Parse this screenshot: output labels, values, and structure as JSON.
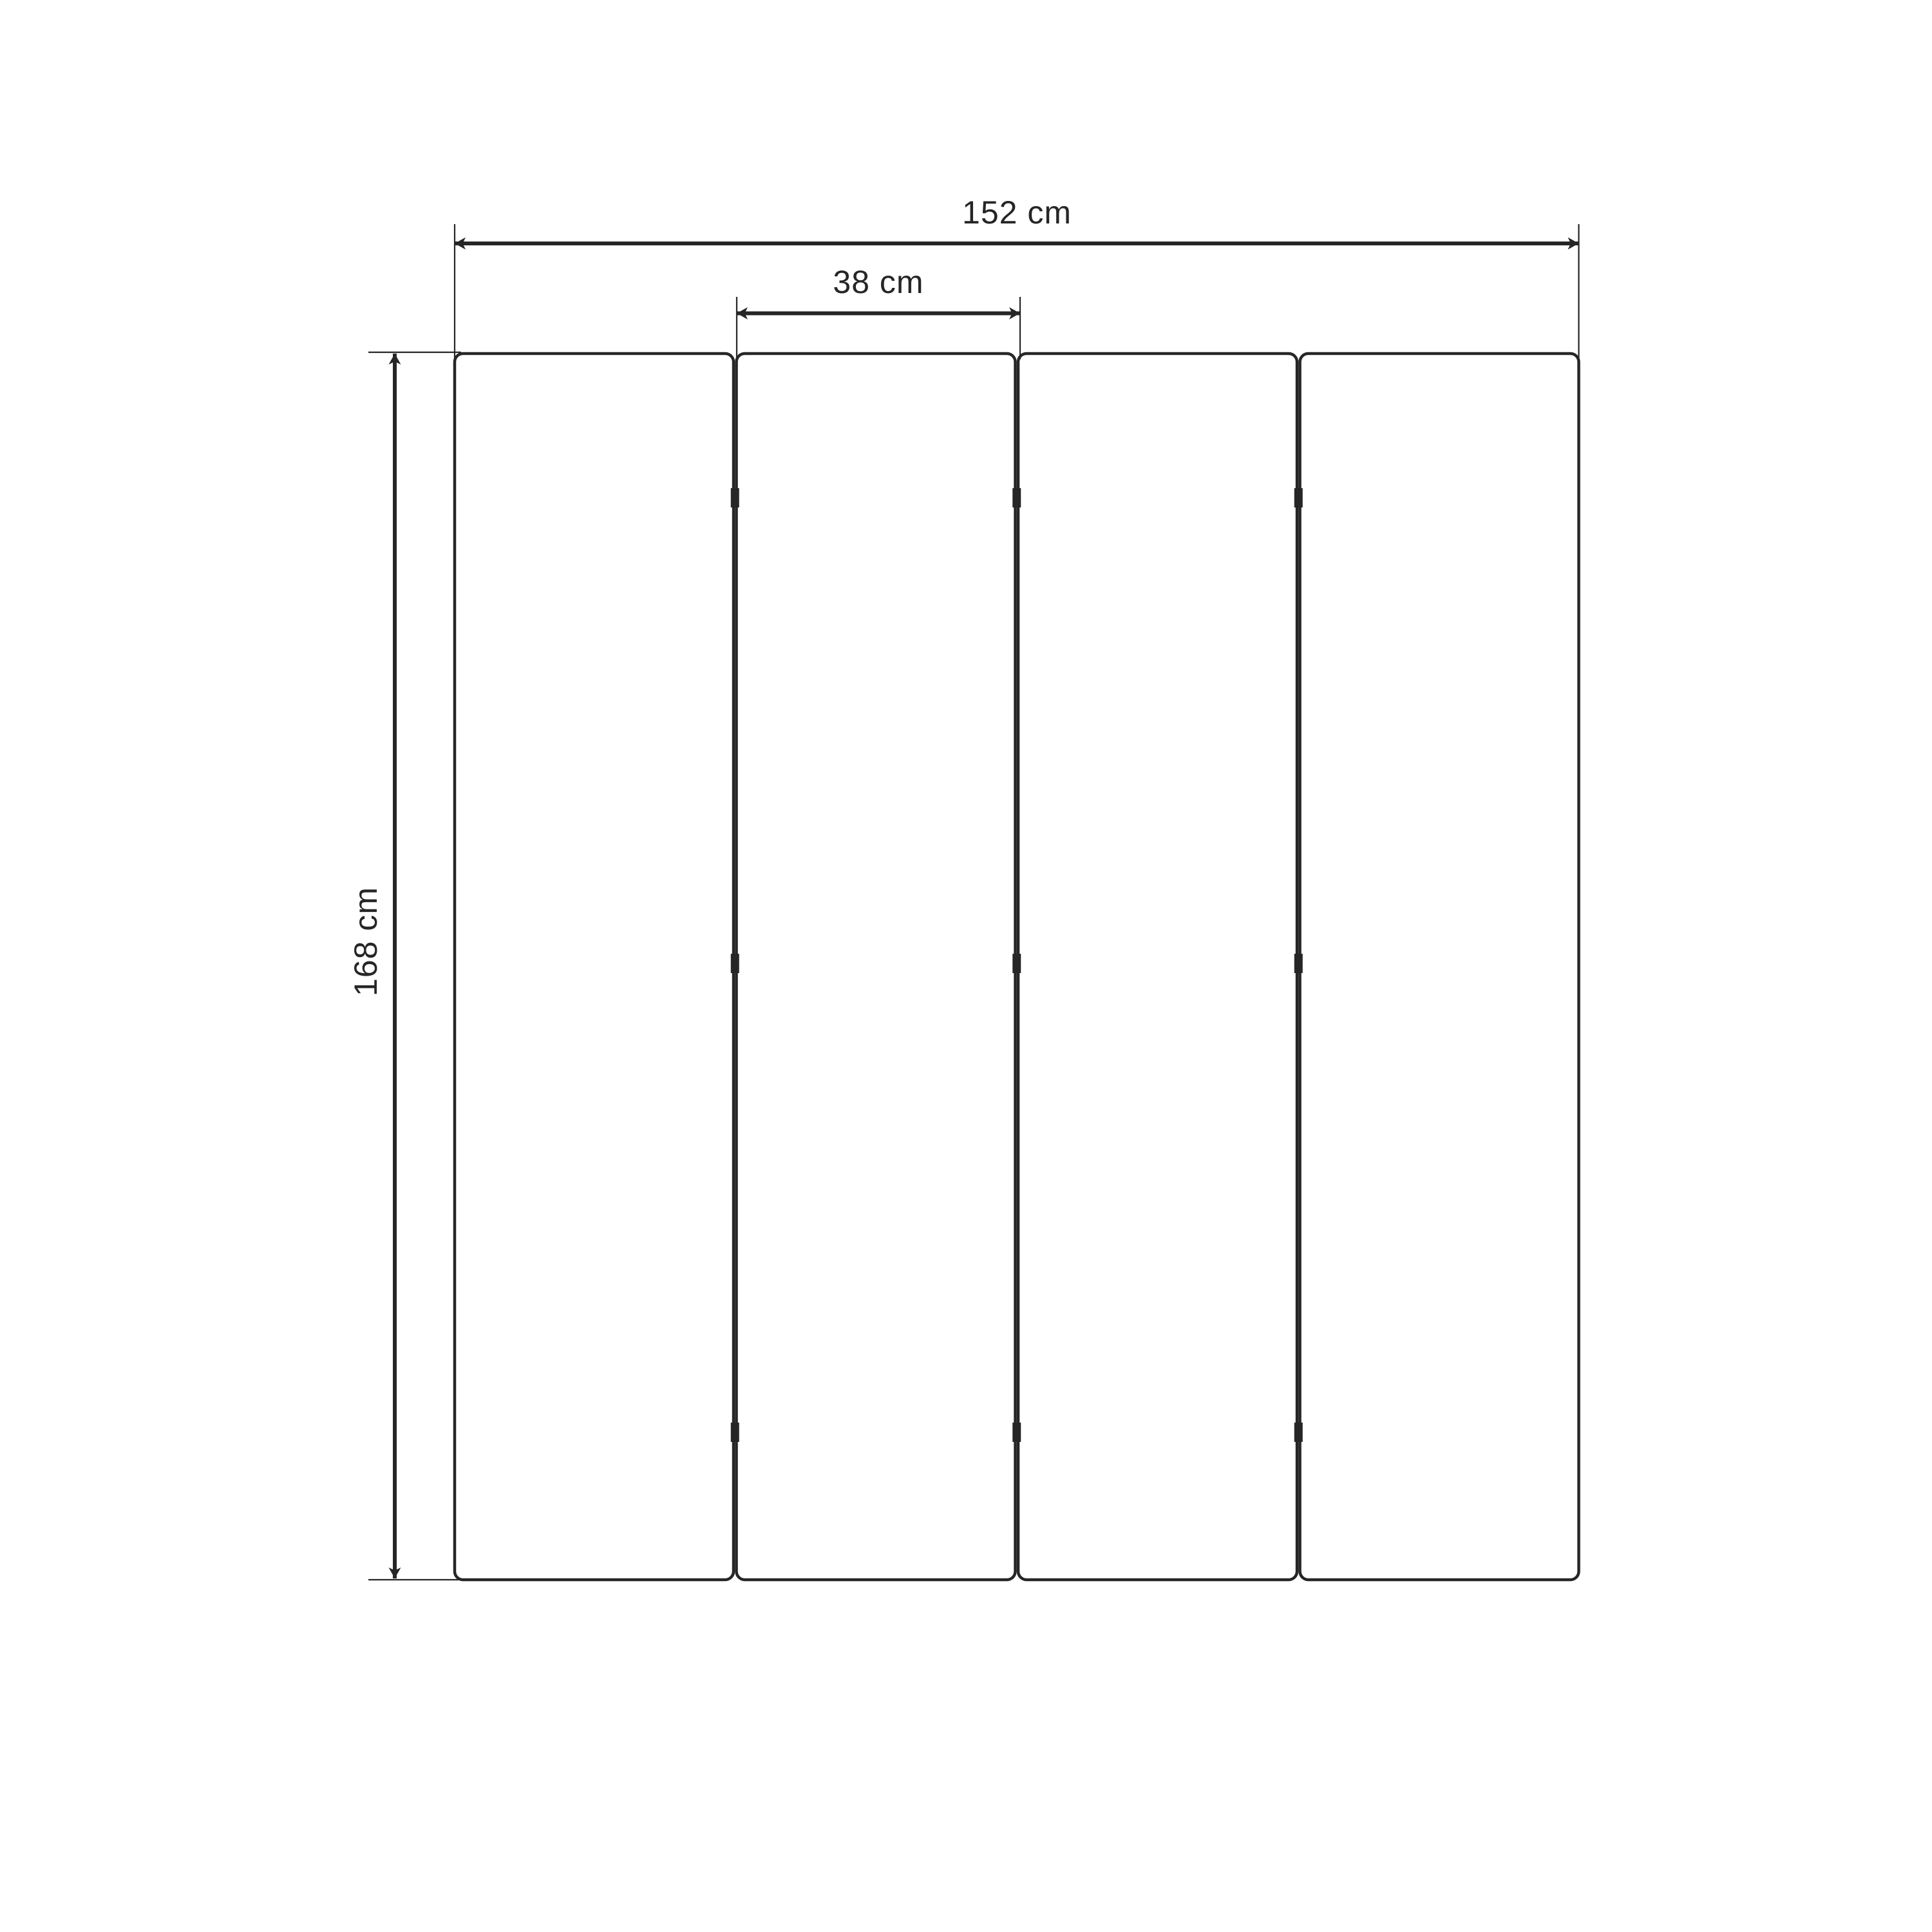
{
  "page": {
    "background": "#ffffff"
  },
  "drawing": {
    "kind": "dimensioned-technical-drawing",
    "colors": {
      "line": "#262626",
      "background": "#ffffff"
    },
    "panels": {
      "count": 4
    },
    "hinges": {
      "rows": 3,
      "gaps": 3
    },
    "dimensions": {
      "overall_width": {
        "label": "152 cm",
        "value": 152,
        "unit": "cm"
      },
      "panel_width": {
        "label": "38 cm",
        "value": 38,
        "unit": "cm"
      },
      "overall_height": {
        "label": "168 cm",
        "value": 168,
        "unit": "cm"
      }
    }
  }
}
